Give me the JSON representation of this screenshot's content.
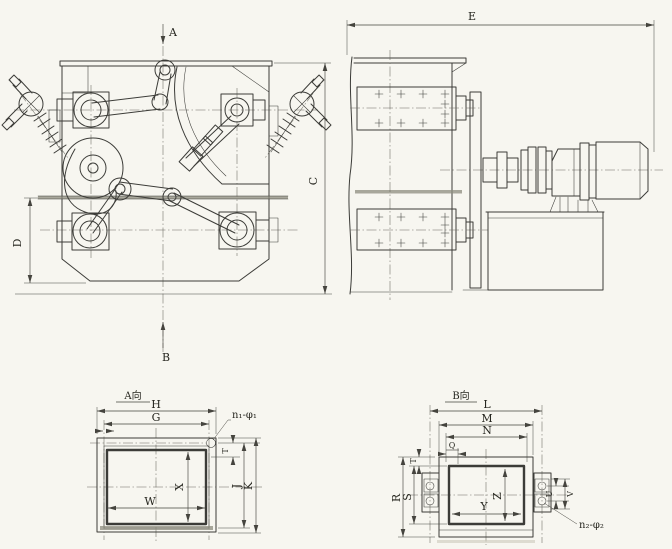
{
  "drawing": {
    "front_view": {
      "section_arrow_top": "A",
      "section_arrow_bottom": "B",
      "dim_overall_height": "C",
      "dim_base_height": "D"
    },
    "side_view": {
      "dim_overall_length": "E"
    },
    "view_a": {
      "title": "A向",
      "dim_outer_width": "H",
      "dim_bolt_width": "G",
      "dim_opening_width": "W",
      "dim_opening_height": "X",
      "dim_edge": "T",
      "dim_inner_height": "J",
      "dim_outer_height": "K",
      "bolt_note": "n₁-φ₁"
    },
    "view_b": {
      "title": "B向",
      "dim_outer_width": "L",
      "dim_mid_width": "M",
      "dim_inner_width": "N",
      "dim_offset": "Q",
      "dim_outer_height": "R",
      "dim_inner_height": "S",
      "dim_edge": "T",
      "dim_opening_width": "Y",
      "dim_opening_height": "Z",
      "dim_bolt_span": "U",
      "dim_plate_span": "V",
      "bolt_note": "n₂-φ₂"
    },
    "colors": {
      "paper": "#f7f6f0",
      "line": "#3c3c38",
      "dim_line": "#45443e"
    }
  }
}
